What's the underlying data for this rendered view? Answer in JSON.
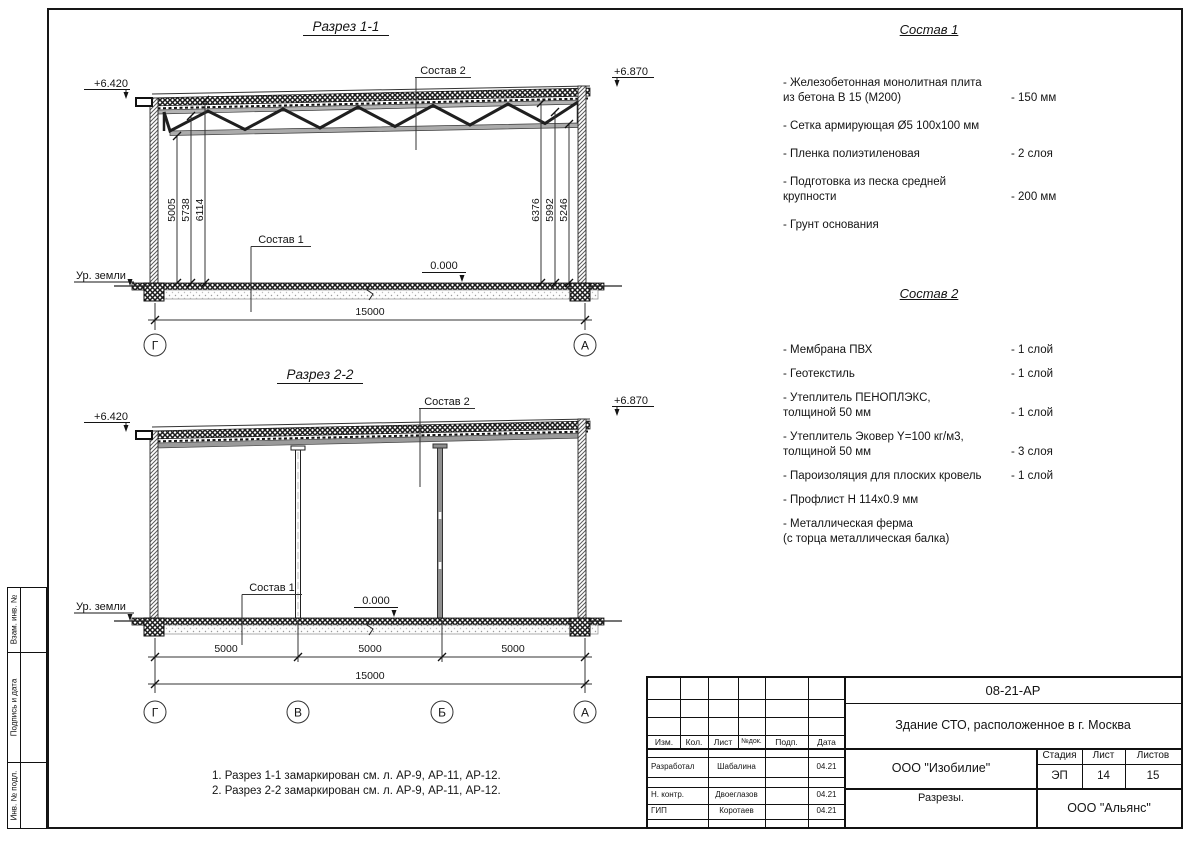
{
  "sections": {
    "s1": {
      "title": "Разрез 1-1",
      "elev_left": "+6.420",
      "elev_right": "+6.870",
      "sostav2_label": "Состав 2",
      "sostav1_label": "Состав 1",
      "zero_label": "0.000",
      "ground_label": "Ур. земли",
      "dims_left": [
        "5005",
        "5738",
        "6114"
      ],
      "dims_right": [
        "6376",
        "5992",
        "5246"
      ],
      "total_dim": "15000",
      "axes": [
        "Г",
        "А"
      ]
    },
    "s2": {
      "title": "Разрез 2-2",
      "elev_left": "+6.420",
      "elev_right": "+6.870",
      "sostav2_label": "Состав 2",
      "sostav1_label": "Состав 1",
      "zero_label": "0.000",
      "ground_label": "Ур. земли",
      "span_dims": [
        "5000",
        "5000",
        "5000"
      ],
      "total_dim": "15000",
      "axes": [
        "Г",
        "В",
        "Б",
        "А"
      ]
    }
  },
  "sostav1": {
    "title": "Состав 1",
    "items": [
      {
        "line1": "- Железобетонная  монолитная плита",
        "line2": "из бетона В 15 (М200)",
        "value": "- 150 мм"
      },
      {
        "line1": "- Сетка армирующая Ø5 100х100 мм"
      },
      {
        "line1": "- Пленка полиэтиленовая",
        "value": "-  2 слоя"
      },
      {
        "line1": "- Подготовка из песка средней",
        "line2": "крупности",
        "value": "- 200 мм"
      },
      {
        "line1": "- Грунт основания"
      }
    ]
  },
  "sostav2": {
    "title": "Состав 2",
    "items": [
      {
        "line1": "- Мембрана ПВХ",
        "value": "- 1 слой"
      },
      {
        "line1": "- Геотекстиль",
        "value": "- 1 слой"
      },
      {
        "line1": "- Утеплитель ПЕНОПЛЭКС,",
        "line2": "толщиной 50 мм",
        "value": "- 1 слой"
      },
      {
        "line1": "- Утеплитель Эковер Y=100 кг/м3,",
        "line2": "толщиной 50 мм",
        "value": "- 3 слоя"
      },
      {
        "line1": "- Пароизоляция для плоских кровель",
        "value": "- 1 слой"
      },
      {
        "line1": "- Профлист Н 114х0.9 мм"
      },
      {
        "line1": "- Металлическая ферма",
        "line2": "(с торца металлическая балка)"
      }
    ]
  },
  "notes": {
    "line1": "1. Разрез 1-1 замаркирован см. л. АР-9, АР-11, АР-12.",
    "line2": "2. Разрез 2-2 замаркирован см. л. АР-9, АР-11, АР-12."
  },
  "stamp": {
    "doc_number": "08-21-АР",
    "project_title": "Здание СТО, расположенное в г. Москва",
    "header_cols": [
      "Изм.",
      "Кол.",
      "Лист",
      "№док.",
      "Подп.",
      "Дата"
    ],
    "rows": [
      {
        "role": "Разработал",
        "name": "Шабалина",
        "date": "04.21"
      },
      {
        "role": "Н. контр.",
        "name": "Двоеглазов",
        "date": "04.21"
      },
      {
        "role": "ГИП",
        "name": "Коротаев",
        "date": "04.21"
      }
    ],
    "company": "ООО \"Изобилие\"",
    "stage_label": "Стадия",
    "sheet_label": "Лист",
    "sheets_label": "Листов",
    "stage": "ЭП",
    "sheet": "14",
    "sheets": "15",
    "drawing_title": "Разрезы.",
    "contractor": "ООО \"Альянс\""
  },
  "margin": {
    "box1": "Взам. инв. №",
    "box2": "Подпись и дата",
    "box3": "Инв. № подл."
  }
}
